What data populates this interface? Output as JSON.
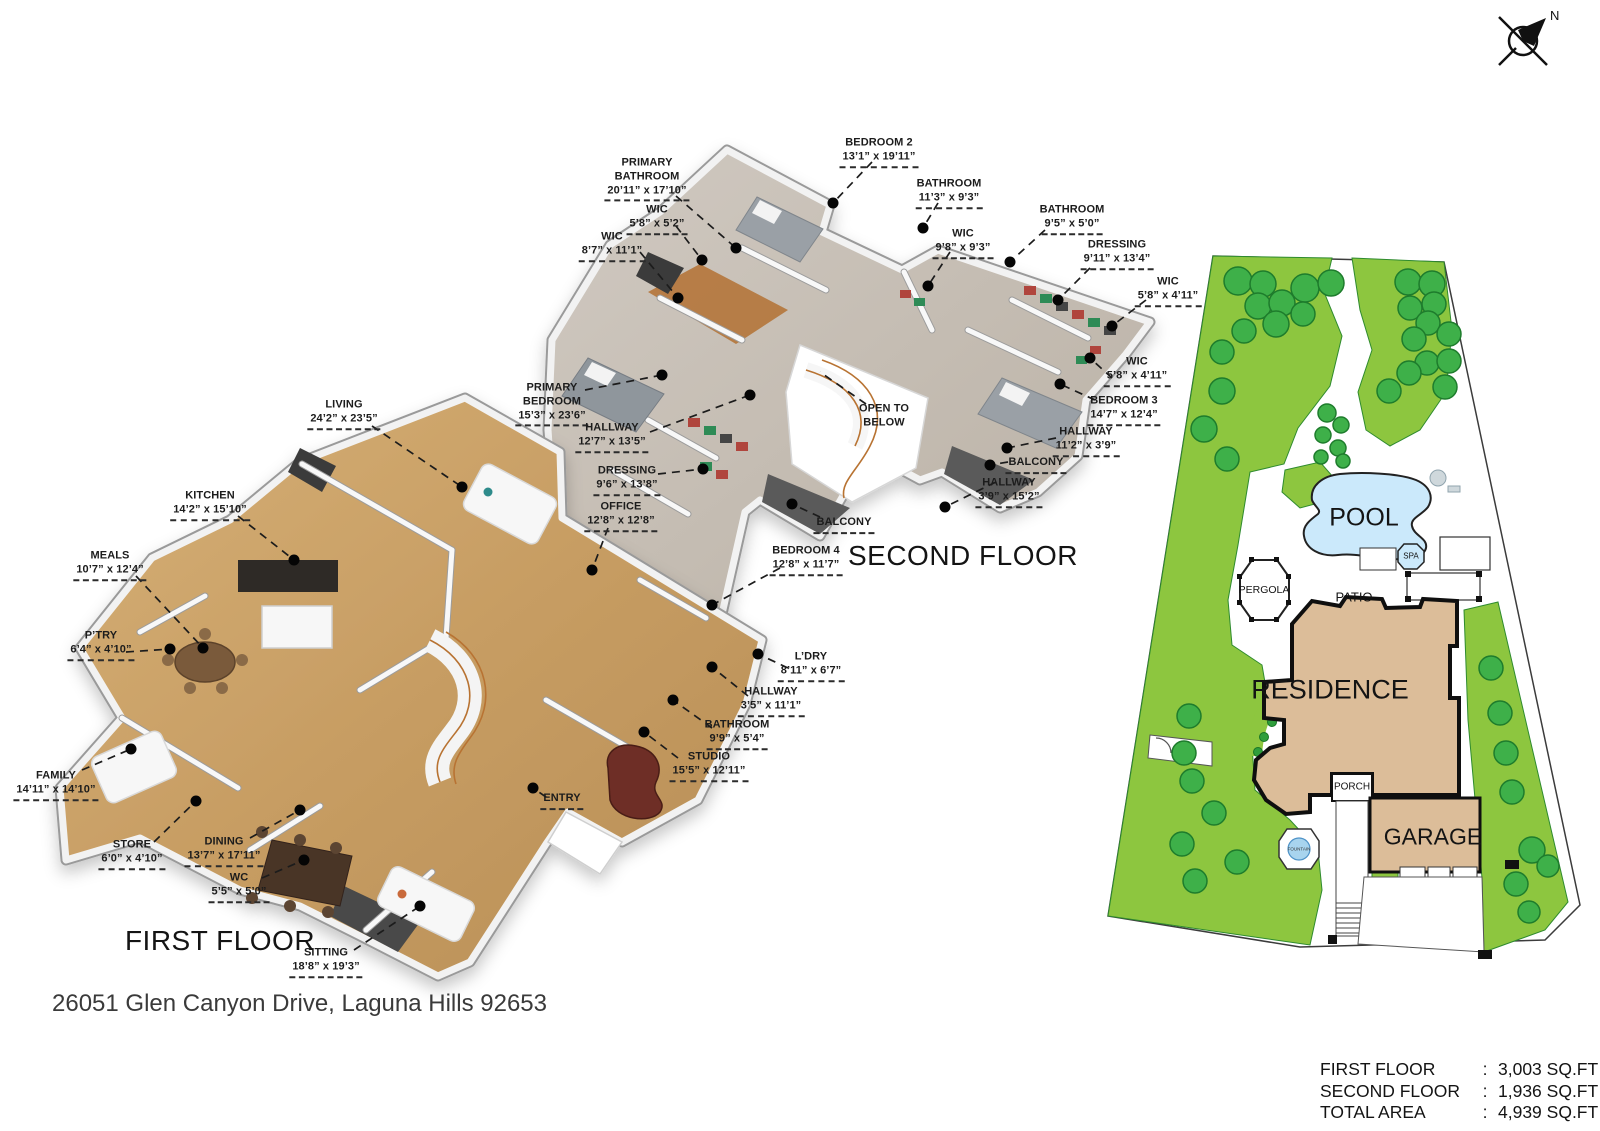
{
  "compass": {
    "north": "N"
  },
  "address": "26051 Glen Canyon Drive, Laguna Hills 92653",
  "first_floor": {
    "title": "FIRST FLOOR",
    "labels": [
      {
        "room": "LIVING",
        "dims": "24’2” x 23’5”"
      },
      {
        "room": "KITCHEN",
        "dims": "14’2” x 15’10”"
      },
      {
        "room": "MEALS",
        "dims": "10’7” x 12’4”"
      },
      {
        "room": "P’TRY",
        "dims": "6’4” x 4’10”"
      },
      {
        "room": "FAMILY",
        "dims": "14’11” x 14’10”"
      },
      {
        "room": "STORE",
        "dims": "6’0” x 4’10”"
      },
      {
        "room": "DINING",
        "dims": "13’7” x 17’11”"
      },
      {
        "room": "WC",
        "dims": "5’5” x 5’0”"
      },
      {
        "room": "SITTING",
        "dims": "18’8” x 19’3”"
      },
      {
        "room": "L’DRY",
        "dims": "8’11” x 6’7”"
      },
      {
        "room": "HALLWAY",
        "dims": "3’5” x 11’1”"
      },
      {
        "room": "BATHROOM",
        "dims": "9’9” x 5’4”"
      },
      {
        "room": "STUDIO",
        "dims": "15’5” x 12’11”"
      },
      {
        "room": "ENTRY",
        "dims": ""
      }
    ]
  },
  "second_floor": {
    "title": "SECOND FLOOR",
    "labels": [
      {
        "room": "PRIMARY\nBATHROOM",
        "dims": "20’11” x 17’10”"
      },
      {
        "room": "WIC",
        "dims": "5’8” x 5’2”"
      },
      {
        "room": "WIC",
        "dims": "8’7” x 11’1”"
      },
      {
        "room": "BEDROOM 2",
        "dims": "13’1” x 19’11”"
      },
      {
        "room": "BATHROOM",
        "dims": "11’3” x 9’3”"
      },
      {
        "room": "WIC",
        "dims": "9’8” x 9’3”"
      },
      {
        "room": "BATHROOM",
        "dims": "9’5” x 5’0”"
      },
      {
        "room": "DRESSING",
        "dims": "9’11” x 13’4”"
      },
      {
        "room": "WIC",
        "dims": "5’8” x 4’11”"
      },
      {
        "room": "WIC",
        "dims": "5’8” x 4’11”"
      },
      {
        "room": "PRIMARY\nBEDROOM",
        "dims": "15’3” x 23’6”"
      },
      {
        "room": "HALLWAY",
        "dims": "12’7” x 13’5”"
      },
      {
        "room": "OPEN TO\nBELOW",
        "dims": ""
      },
      {
        "room": "BEDROOM 3",
        "dims": "14’7” x 12’4”"
      },
      {
        "room": "HALLWAY",
        "dims": "11’2” x 3’9”"
      },
      {
        "room": "DRESSING",
        "dims": "9’6” x 13’8”"
      },
      {
        "room": "BALCONY",
        "dims": ""
      },
      {
        "room": "OFFICE",
        "dims": "12’8” x 12’8”"
      },
      {
        "room": "HALLWAY",
        "dims": "3’9” x 15’2”"
      },
      {
        "room": "BALCONY",
        "dims": ""
      },
      {
        "room": "BEDROOM 4",
        "dims": "12’8” x 11’7”"
      }
    ]
  },
  "site_plan": {
    "pool": "POOL",
    "spa": "SPA",
    "pergola": "PERGOLA",
    "patio": "PATIO",
    "residence": "RESIDENCE",
    "porch": "PORCH",
    "garage": "GARAGE",
    "fountain": "FOUNTAIN"
  },
  "area_table": {
    "rows": [
      {
        "label": "FIRST FLOOR",
        "sep": ":",
        "value": "3,003 SQ.FT"
      },
      {
        "label": "SECOND FLOOR",
        "sep": ":",
        "value": "1,936 SQ.FT"
      },
      {
        "label": "TOTAL AREA",
        "sep": ":",
        "value": "4,939 SQ.FT"
      }
    ]
  },
  "palette": {
    "grass": "#8dc63f",
    "tree": "#3eb049",
    "pool_water": "#cbe9fb",
    "residence_fill": "#dcbd99",
    "wood_floor": "#c9a165",
    "carpet_floor": "#c6bdb2",
    "wall": "#f2f2f2",
    "label_ink": "#1e1e1e"
  }
}
